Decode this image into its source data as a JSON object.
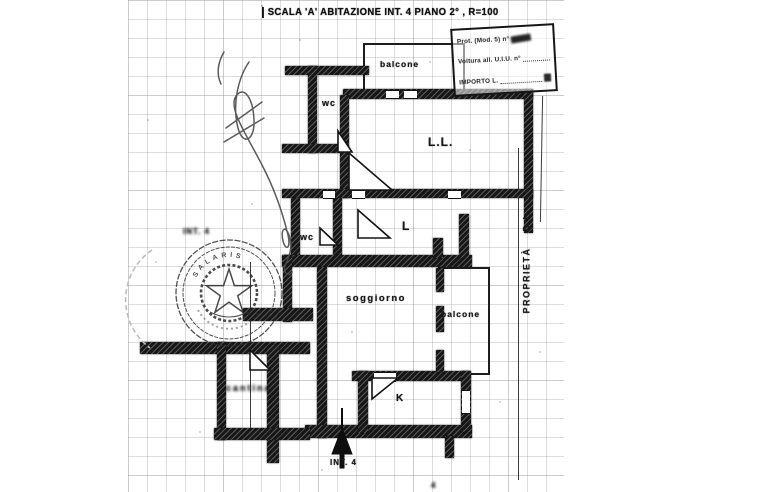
{
  "colors": {
    "ink": "#1a1a1a",
    "paper": "#ffffff",
    "grid_line": "#9aa0a4",
    "seal_ink": "#2e2e2e"
  },
  "header": {
    "title": "SCALA 'A' ABITAZIONE INT. 4 PIANO 2° , R=100"
  },
  "protocol_stamp": {
    "line1_label": "Prot. (Mod. 5) n°",
    "line2_label": "Voltura all. U.I.U. n°",
    "line3_label": "IMPORTO L."
  },
  "floor_plan": {
    "rooms": {
      "balcony_top": "balcone",
      "wc_top": "wc",
      "bedroom_ll": "L.L.",
      "bedroom_l": "L",
      "wc_mid": "wc",
      "living_room": "soggiorno",
      "balcony_mid": "balcone",
      "kitchen": "K",
      "cellar": "cantina"
    },
    "entrance_label": "INT. 4"
  },
  "annotations": {
    "property_label": "PROPRIETÀ",
    "property_abbr": "D.I.",
    "side_note": "INT. 4",
    "corner_mark": "4",
    "seal_name": "SALARIS"
  }
}
